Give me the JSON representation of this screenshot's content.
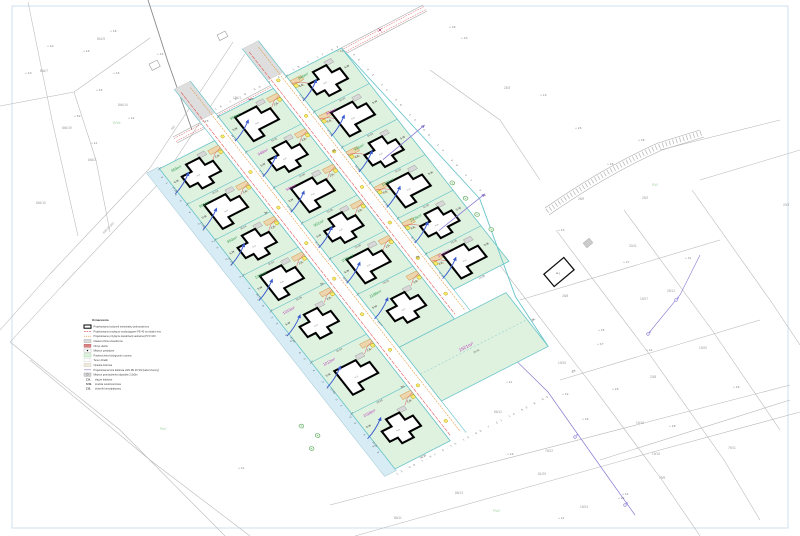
{
  "drawing": {
    "street_label": "846/10 (dr)",
    "street_label2": "(dr)",
    "legend": {
      "title": "Oznaczenia",
      "items": [
        {
          "swatch": "building",
          "label": "Projektowany budynek mieszkalny jednorodzinny"
        },
        {
          "swatch": "water-line",
          "label": "Projektowane przyłącze wodociągowe PE 40 na działce inw."
        },
        {
          "swatch": "sewer-line",
          "label": "Projektowane przyłącze kanalizacji sanitarnej PVC 160"
        },
        {
          "swatch": "paved",
          "label": "Nawierzchnia utwardzona"
        },
        {
          "swatch": "roof",
          "label": "Obrys dachu"
        },
        {
          "swatch": "parking",
          "label": "Miejsce postojowe"
        },
        {
          "swatch": "bio",
          "label": "Powierzchnia biologicznie czynna"
        },
        {
          "swatch": "lot",
          "label": "Teren działki"
        },
        {
          "swatch": "terrace",
          "label": "Opaska żwirowa"
        },
        {
          "swatch": "power-line",
          "label": "Projektowana linia kablowa eNN PE 40 SN (kabel ziemny)"
        },
        {
          "swatch": "waste",
          "label": "Miejsce gromadzenia odpadów 2,5x5m"
        }
      ],
      "abbreviations": [
        {
          "abbr": "Z.K.",
          "label": "złącze kablowe"
        },
        {
          "abbr": "S.W.",
          "label": "studnia wodomierzowa"
        },
        {
          "abbr": "Z.B.",
          "label": "zbiornik bezodpływowy"
        }
      ]
    },
    "site": {
      "labels": {
        "sw": "S.W",
        "zb": "Z.B.",
        "zk": "ZK"
      },
      "house_label": "m.jn",
      "columns": [
        {
          "x": 0,
          "w": 62,
          "bounds": [
            20,
            65,
            110,
            155,
            200,
            265,
            330,
            400
          ],
          "plots": [
            {
              "area": "959m²",
              "color": "green",
              "wdim": "17.28",
              "ddim": "35.04"
            },
            {
              "area": "951m²",
              "color": "green",
              "wdim": "17.40",
              "ddim": "35.04"
            },
            {
              "area": "950m²",
              "color": "green",
              "wdim": "17.24",
              "ddim": "35.04"
            },
            {
              "area": "1000m²",
              "color": "green",
              "wdim": "16.72",
              "ddim": "35.04"
            },
            {
              "area": "1019m²",
              "color": "magenta",
              "wdim": "17.45",
              "ddim": "55.04"
            },
            {
              "area": "1012m²",
              "color": "magenta",
              "wdim": "17.40",
              "ddim": "58.28"
            },
            {
              "area": "1018m²",
              "color": "magenta",
              "wdim": "17.24",
              "ddim": "58.28"
            }
          ]
        },
        {
          "x": 80,
          "w": 62,
          "bounds": [
            0,
            45,
            90,
            135,
            180,
            225,
            292
          ],
          "plots": [
            {
              "area": "950m²",
              "color": "green",
              "wdim": "18.72",
              "ddim": "33.00"
            },
            {
              "area": "948m²",
              "color": "magenta",
              "wdim": "17.94",
              "ddim": "33.00"
            },
            {
              "area": "946m²",
              "color": "magenta",
              "wdim": "17.53",
              "ddim": "33.00"
            },
            {
              "area": "951m²",
              "color": "green",
              "wdim": "16.43",
              "ddim": "33.00"
            },
            {
              "area": "1001m²",
              "color": "green",
              "wdim": "18.00",
              "ddim": "34.03"
            },
            {
              "area": "1188m²",
              "color": "green",
              "wdim": "16.77",
              "ddim": "55.00"
            }
          ]
        },
        {
          "x": 160,
          "w": 62,
          "bounds": [
            -5,
            40,
            85,
            130,
            175,
            220,
            265
          ],
          "plots": [
            {
              "area": "946m²",
              "color": "green",
              "wdim": "17.94",
              "ddim": "34.03"
            },
            {
              "area": "945m²",
              "color": "magenta",
              "wdim": "17.53",
              "ddim": "34.03"
            },
            {
              "area": "945m²",
              "color": "green",
              "wdim": "15.06",
              "ddim": "34.03"
            },
            {
              "area": "1000m²",
              "color": "green",
              "wdim": "17.24",
              "ddim": "33.00"
            },
            {
              "area": "1006m²",
              "color": "green",
              "wdim": "16.72",
              "ddim": "33.00"
            },
            {
              "area": "1012m²",
              "color": "magenta",
              "wdim": "11.19",
              "ddim": "15.38"
            }
          ]
        }
      ],
      "big_plot": {
        "area": "1521m²",
        "color": "magenta",
        "dim": "16.43"
      },
      "chains": {
        "west": "31.69   4.26   13.00   4.4.26   13.00   63.4.26   32.00   4.66",
        "south": "13.09   7.61  3.75   13.09   7.21   14.63   8.00",
        "top": "16.72   9.00   8.41   16.7   17.53",
        "east": "34.03   14.26   15.06   14.26   17.94"
      }
    },
    "background": {
      "parcel_labels": [
        {
          "t": "846/7",
          "x": 40,
          "y": 72
        },
        {
          "t": "841/9",
          "x": 97,
          "y": 40
        },
        {
          "t": "846/14",
          "x": 118,
          "y": 106
        },
        {
          "t": "846/19",
          "x": 62,
          "y": 129
        },
        {
          "t": "846/3",
          "x": 88,
          "y": 161
        },
        {
          "t": "186/1",
          "x": 233,
          "y": 99
        },
        {
          "t": "846/10",
          "x": 36,
          "y": 204
        },
        {
          "t": "25/3",
          "x": 504,
          "y": 89
        },
        {
          "t": "26/9",
          "x": 578,
          "y": 200
        },
        {
          "t": "25/2",
          "x": 642,
          "y": 199
        },
        {
          "t": "30/11",
          "x": 629,
          "y": 247
        },
        {
          "t": "26/8",
          "x": 562,
          "y": 297
        },
        {
          "t": "25/12",
          "x": 667,
          "y": 292
        },
        {
          "t": "19/20",
          "x": 699,
          "y": 349
        },
        {
          "t": "19/27",
          "x": 640,
          "y": 300
        },
        {
          "t": "19/24",
          "x": 580,
          "y": 508
        },
        {
          "t": "20/3",
          "x": 783,
          "y": 206
        },
        {
          "t": "86/13",
          "x": 455,
          "y": 494
        },
        {
          "t": "86/12",
          "x": 494,
          "y": 413
        },
        {
          "t": "76/22",
          "x": 545,
          "y": 452
        },
        {
          "t": "86/11",
          "x": 394,
          "y": 519
        },
        {
          "t": "79/9",
          "x": 659,
          "y": 479
        },
        {
          "t": "79/11",
          "x": 728,
          "y": 449
        },
        {
          "t": "19/26",
          "x": 558,
          "y": 364
        },
        {
          "t": "19/16",
          "x": 636,
          "y": 424
        },
        {
          "t": "19/15",
          "x": 652,
          "y": 455
        },
        {
          "t": "81/25",
          "x": 538,
          "y": 475
        },
        {
          "t": "20/8",
          "x": 650,
          "y": 378
        }
      ],
      "landuse_labels": [
        {
          "t": "RIVa",
          "x": 113,
          "y": 124
        },
        {
          "t": "PsV",
          "x": 160,
          "y": 430
        },
        {
          "t": "RVI",
          "x": 652,
          "y": 186
        },
        {
          "t": "PsIV",
          "x": 493,
          "y": 512
        }
      ],
      "spot_heights": [
        {
          "v": "4.9",
          "x": 50,
          "y": 47
        },
        {
          "v": "4.6",
          "x": 86,
          "y": 52
        },
        {
          "v": "4.8",
          "x": 113,
          "y": 32
        },
        {
          "v": "4.5",
          "x": 99,
          "y": 91
        },
        {
          "v": "4.6",
          "x": 116,
          "y": 74
        },
        {
          "v": "4.2",
          "x": 131,
          "y": 119
        },
        {
          "v": "4.1",
          "x": 94,
          "y": 144
        },
        {
          "v": "5.2",
          "x": 77,
          "y": 117
        },
        {
          "v": "4.9",
          "x": 28,
          "y": 74
        },
        {
          "v": "4.4",
          "x": 160,
          "y": 55
        },
        {
          "v": "3.9",
          "x": 452,
          "y": 28
        },
        {
          "v": "3.3",
          "x": 464,
          "y": 39
        },
        {
          "v": "2.8",
          "x": 641,
          "y": 141
        },
        {
          "v": "2.6",
          "x": 578,
          "y": 129
        },
        {
          "v": "2.3",
          "x": 561,
          "y": 231
        },
        {
          "v": "2.7",
          "x": 626,
          "y": 263
        },
        {
          "v": "3.1",
          "x": 688,
          "y": 259
        },
        {
          "v": "2.6",
          "x": 601,
          "y": 331
        },
        {
          "v": "2.4",
          "x": 649,
          "y": 351
        },
        {
          "v": "2.1",
          "x": 509,
          "y": 383
        },
        {
          "v": "2.4",
          "x": 621,
          "y": 499
        },
        {
          "v": "2.1",
          "x": 561,
          "y": 519
        },
        {
          "v": "2.8",
          "x": 672,
          "y": 427
        },
        {
          "v": "1.9",
          "x": 543,
          "y": 96
        },
        {
          "v": "3.1",
          "x": 241,
          "y": 469
        },
        {
          "v": "2.6",
          "x": 736,
          "y": 388
        },
        {
          "v": "3.2",
          "x": 565,
          "y": 395
        },
        {
          "v": "2.8",
          "x": 615,
          "y": 390
        },
        {
          "v": "2.6",
          "x": 585,
          "y": 420
        },
        {
          "v": "3.7",
          "x": 600,
          "y": 345
        },
        {
          "v": "2.9",
          "x": 510,
          "y": 455
        },
        {
          "v": "4.4",
          "x": 625,
          "y": 495
        },
        {
          "v": "2.5",
          "x": 205,
          "y": 122
        },
        {
          "v": "2.9",
          "x": 250,
          "y": 100
        },
        {
          "v": "3.4",
          "x": 340,
          "y": 52
        },
        {
          "v": "2.6",
          "x": 610,
          "y": 165
        }
      ]
    },
    "colors": {
      "plot_fill": "#dff1df",
      "plot_stroke": "#6cc5ca",
      "area_green": "#2e9e4f",
      "area_magenta": "#bb3fbb",
      "water": "#e03535",
      "sewer": "#e08a25",
      "arrow": "#3a5bd0",
      "road_band": "#d7ecf4",
      "chamber_fill": "#f7ea6e",
      "chamber_stroke": "#b39b00",
      "tree": "#2f8f2f",
      "dim": "#555555",
      "cad_line": "#b5b5b5",
      "cad_text": "#9a9a9a",
      "power": "#8a7ad0",
      "pavement": "#dedede"
    }
  }
}
